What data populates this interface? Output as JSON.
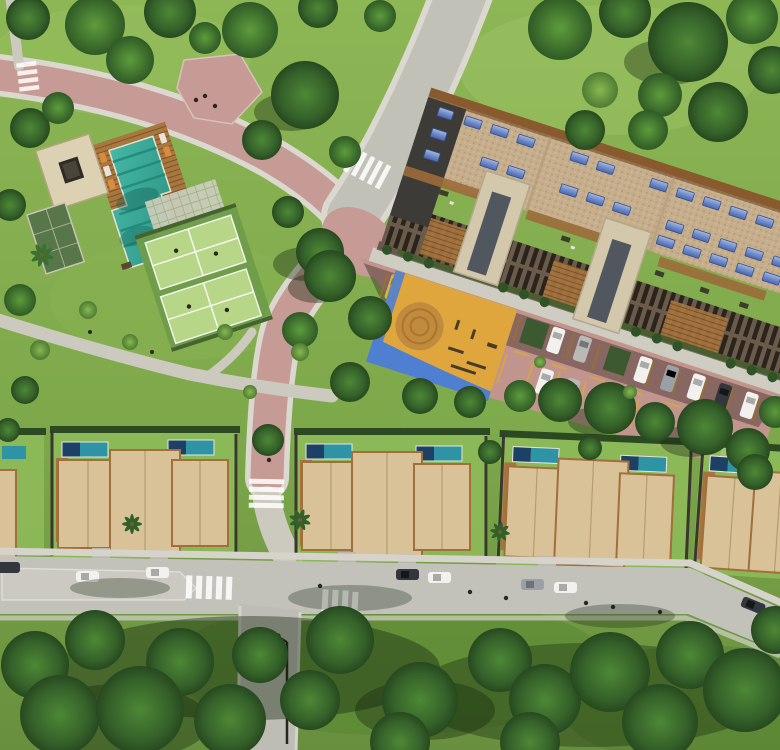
{
  "scene": {
    "title": "Aerial top-down 3D rendering of a residential condominium master plan",
    "style": "photorealistic architectural visualization, no text or UI overlays",
    "sun": "light from upper right, shadows cast toward lower left",
    "areas": {
      "park": "curved rose promenade and plaza through lawns with mature trees (upper left)",
      "clubhouse": "flat-roof pavilion with dark skylight, timber deck with loungers, L-shaped turquoise pool, paver terrace, planted green roof wing",
      "sport_courts": "two light-green padel courts with white markings and players",
      "apartment_building": "long diagonal residential block with tan gravel roof, timber trim walkways, rooftop terraces and rows of blue solar panels",
      "parking_lot": "rose-paved parking court with yellow bay striping, nose-in car rows and a long cast building shadow",
      "playground": "amber play court with circular sand mandala and blue surround band",
      "townhouses": "row of townhouse clusters with tan roofs, timber side decks, private plunge pools and dividing fences",
      "street": "light asphalt residential street with parallel-parked cars, zebra crosswalks, palm trees, street lamp and a wooded park strip below"
    },
    "counts": {
      "padel_courts": 2,
      "townhouse_clusters": 5,
      "townhouse_pools": 8,
      "parking_lot_cars": 18,
      "street_cars": 8,
      "solar_panel_rows": 3,
      "crosswalks": 5,
      "street_lamps": 1,
      "palm_trees": 3
    }
  },
  "palette": {
    "roadPink": "#c79b95",
    "lotPink": "#c2948e",
    "roadGray": "#c2c1b8",
    "street": "#c3c2ba",
    "pathGray": "#ccc9bf",
    "curb": "#dbd8cf",
    "lawn": "#84ac50",
    "lawnDark": "#5d8a38",
    "treeDark": "#2d5323",
    "roofTan": "#c6ae8c",
    "woodTrim": "#8a5a2f",
    "facade": "#6b5b4a",
    "facadeWood": "#a8763f",
    "cream": "#d3c7ac",
    "solarBlue": "#5b79c0",
    "poolTeal": "#36ab9b",
    "deckWood": "#a97340",
    "navyPool": "#1c4066",
    "thPoolTeal": "#2d93a5",
    "thRoof": "#d9c198",
    "thTrim": "#a06f3c",
    "court": "#b7d687",
    "courtFrame": "#6f9c4a",
    "playOrange": "#dfa63e",
    "playSand": "#c08a3f",
    "playBlue": "#4f7fd0",
    "yellowLine": "#d8a93c"
  }
}
